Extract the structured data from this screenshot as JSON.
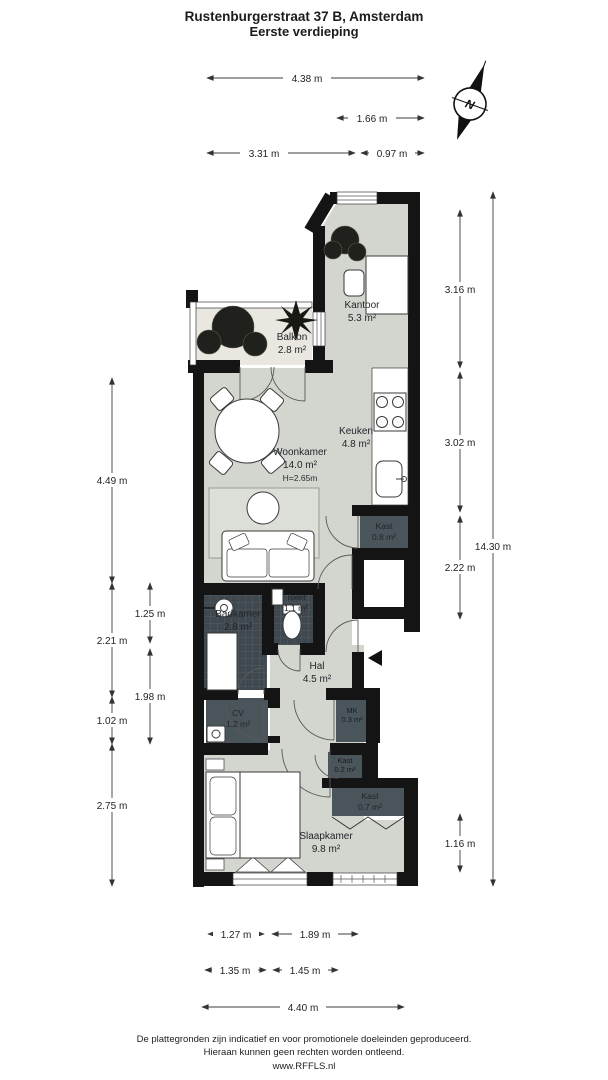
{
  "title": {
    "line1": "Rustenburgerstraat 37 B, Amsterdam",
    "line2": "Eerste verdieping"
  },
  "compass": {
    "north": "N"
  },
  "rooms": {
    "kantoor": {
      "name": "Kantoor",
      "area": "5.3 m²"
    },
    "balkon": {
      "name": "Balkon",
      "area": "2.8 m²"
    },
    "woonkamer": {
      "name": "Woonkamer",
      "area": "14.0 m²",
      "ceiling": "H=2.65m"
    },
    "keuken": {
      "name": "Keuken",
      "area": "4.8 m²"
    },
    "kast_keuken": {
      "name": "Kast",
      "area": "0.8 m²"
    },
    "badkamer": {
      "name": "Badkamer",
      "area": "2.8 m²"
    },
    "toilet": {
      "name": "Toilet",
      "area": "1.1 m²"
    },
    "hal": {
      "name": "Hal",
      "area": "4.5 m²"
    },
    "cv": {
      "name": "CV",
      "area": "1.2 m²"
    },
    "mk": {
      "name": "MK",
      "area": "0.3 m²"
    },
    "kast_klein": {
      "name": "Kast",
      "area": "0.2 m²"
    },
    "kast_slaapkamer": {
      "name": "Kast",
      "area": "0.7 m²"
    },
    "slaapkamer": {
      "name": "Slaapkamer",
      "area": "9.8 m²"
    }
  },
  "dimensions": {
    "top": {
      "total": "4.38 m",
      "kantoor_width": "1.66 m",
      "balkon_width": "3.31 m",
      "kantoor_small": "0.97 m"
    },
    "left": {
      "woonkamer_height": "4.49 m",
      "badkamer_zone": "2.21 m",
      "cv_zone": "1.02 m",
      "slaapkamer_height": "2.75 m",
      "badkamer_height": "1.25 m",
      "hal_zone": "1.98 m"
    },
    "right": {
      "kantoor_height": "3.16 m",
      "keuken_height": "3.02 m",
      "kast_zone": "2.22 m",
      "kast_bottom": "1.16 m",
      "total": "14.30 m"
    },
    "bottom": {
      "row1_left": "1.27 m",
      "row1_right": "1.89 m",
      "row2_left": "1.35 m",
      "row2_right": "1.45 m",
      "total": "4.40 m"
    }
  },
  "footer": {
    "line1": "De plattegronden zijn indicatief en voor promotionele doeleinden geproduceerd.",
    "line2": "Hieraan kunnen geen rechten worden ontleend.",
    "line3": "www.RFFLS.nl"
  },
  "colors": {
    "floor": "#d3d5cf",
    "balkon_floor": "#e9e7df",
    "dark_room": "#4a545b",
    "tiled_room": "#3f484f",
    "wall": "#141414"
  }
}
